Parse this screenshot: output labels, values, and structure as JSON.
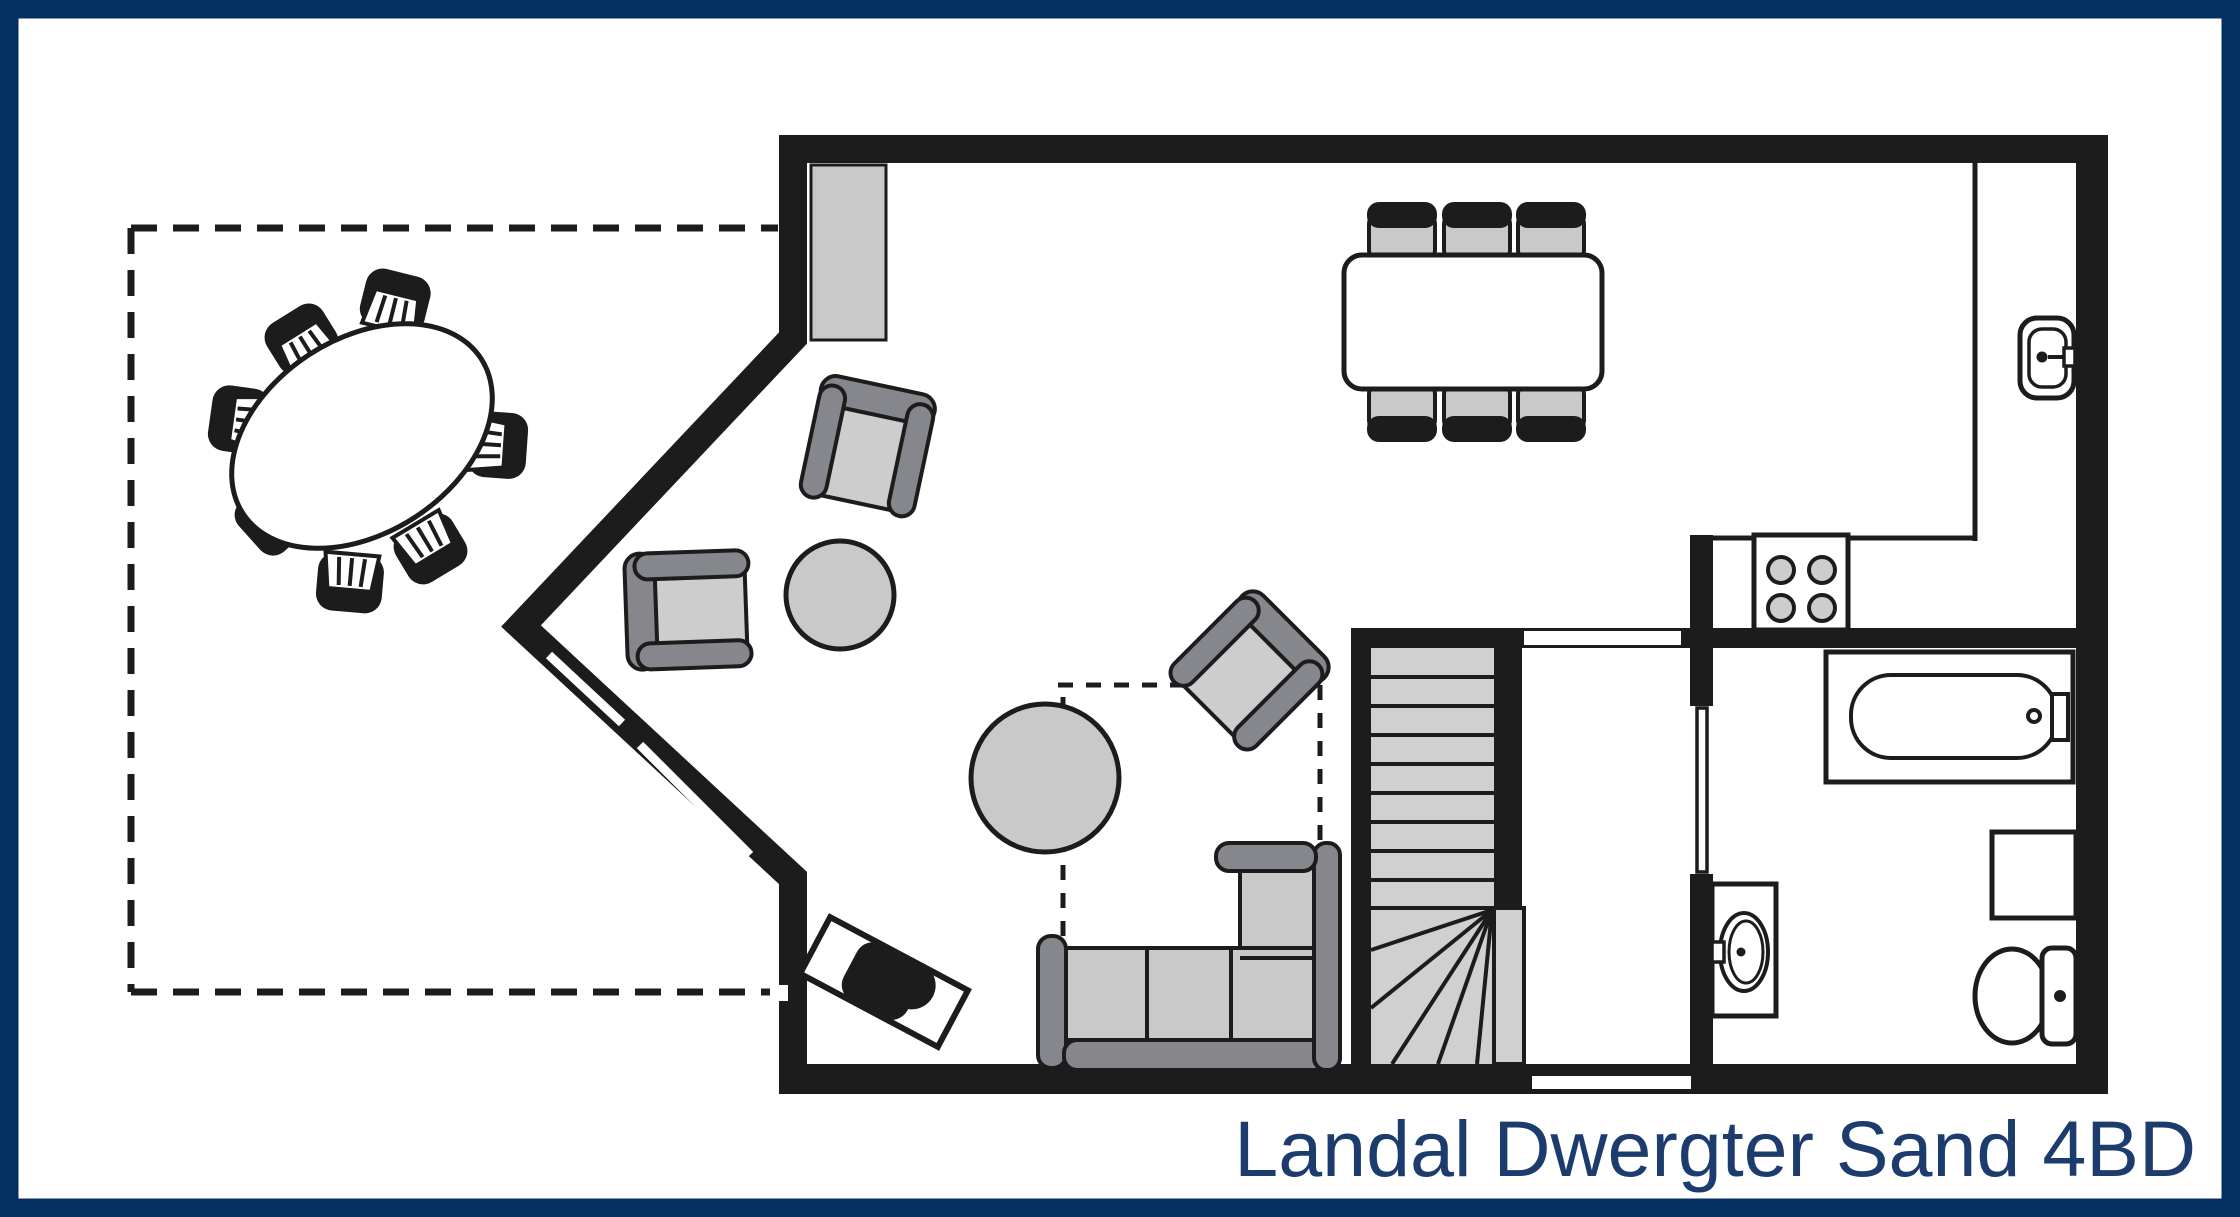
{
  "title": {
    "label": "Landal Dwergter Sand 4BD"
  },
  "colors": {
    "frame_navy": "#04305f",
    "title_text": "#1c3c6e",
    "wall_black": "#1c1c1c",
    "furniture_light_gray": "#c9c9c9",
    "furniture_dark_gray": "#85878c",
    "stair_tread_gray": "#d0d0d0",
    "background_white": "#ffffff"
  }
}
